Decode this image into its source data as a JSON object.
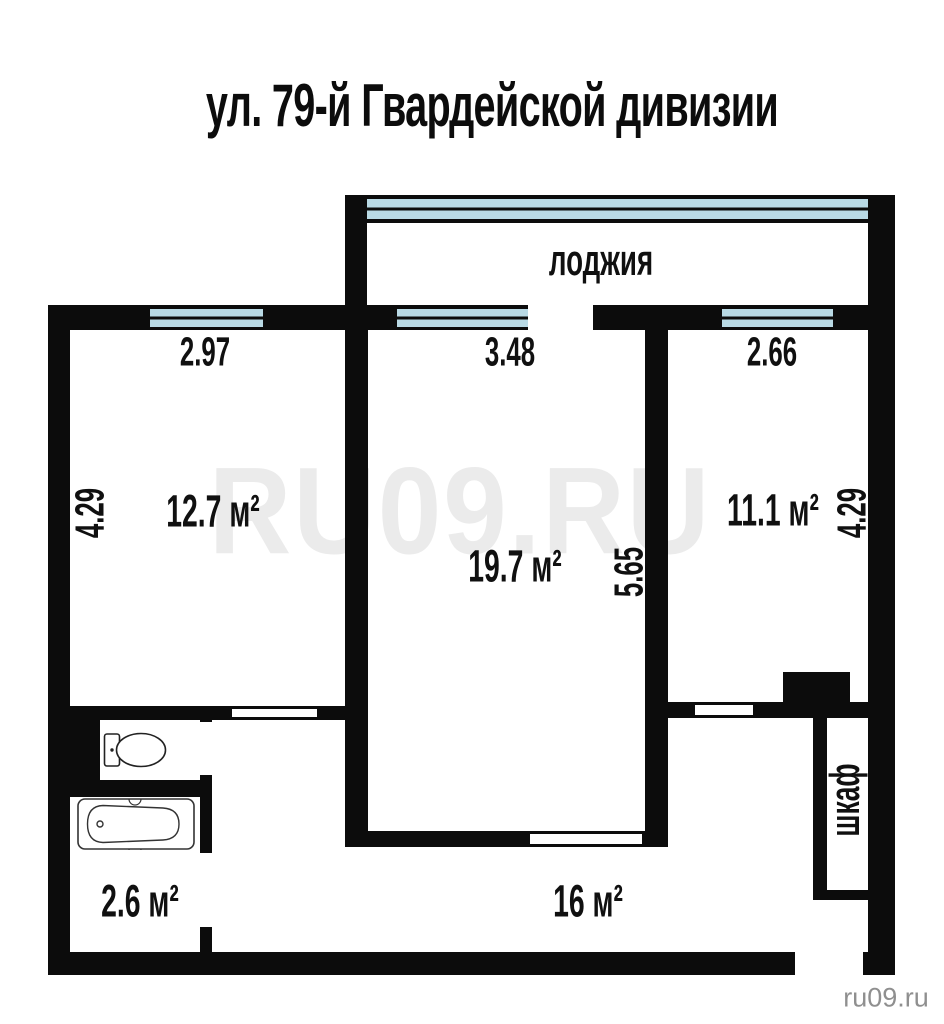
{
  "title": "ул. 79-й Гвардейской дивизии",
  "loggia_label": "лоджия",
  "rooms": {
    "room1": {
      "area": "12.7 м²",
      "width": "2.97",
      "height": "4.29"
    },
    "living": {
      "area": "19.7 м²",
      "width": "3.48",
      "height": "5.65"
    },
    "room2": {
      "area": "11.1 м²",
      "width": "2.66",
      "height": "4.29"
    },
    "hall": {
      "area": "16 м²"
    },
    "bath": {
      "area": "2.6 м²"
    },
    "closet": {
      "label": "шкаф"
    }
  },
  "watermark": {
    "center": "RU09.RU",
    "corner": "ru09.ru"
  },
  "fixtures": {
    "toilet": "toilet",
    "bathtub": "bathtub"
  },
  "colors": {
    "wall": "#0c0c0c",
    "window_glass": "#b9dae5",
    "watermark": "#ebebeb",
    "corner_text": "#8f8f8f"
  }
}
